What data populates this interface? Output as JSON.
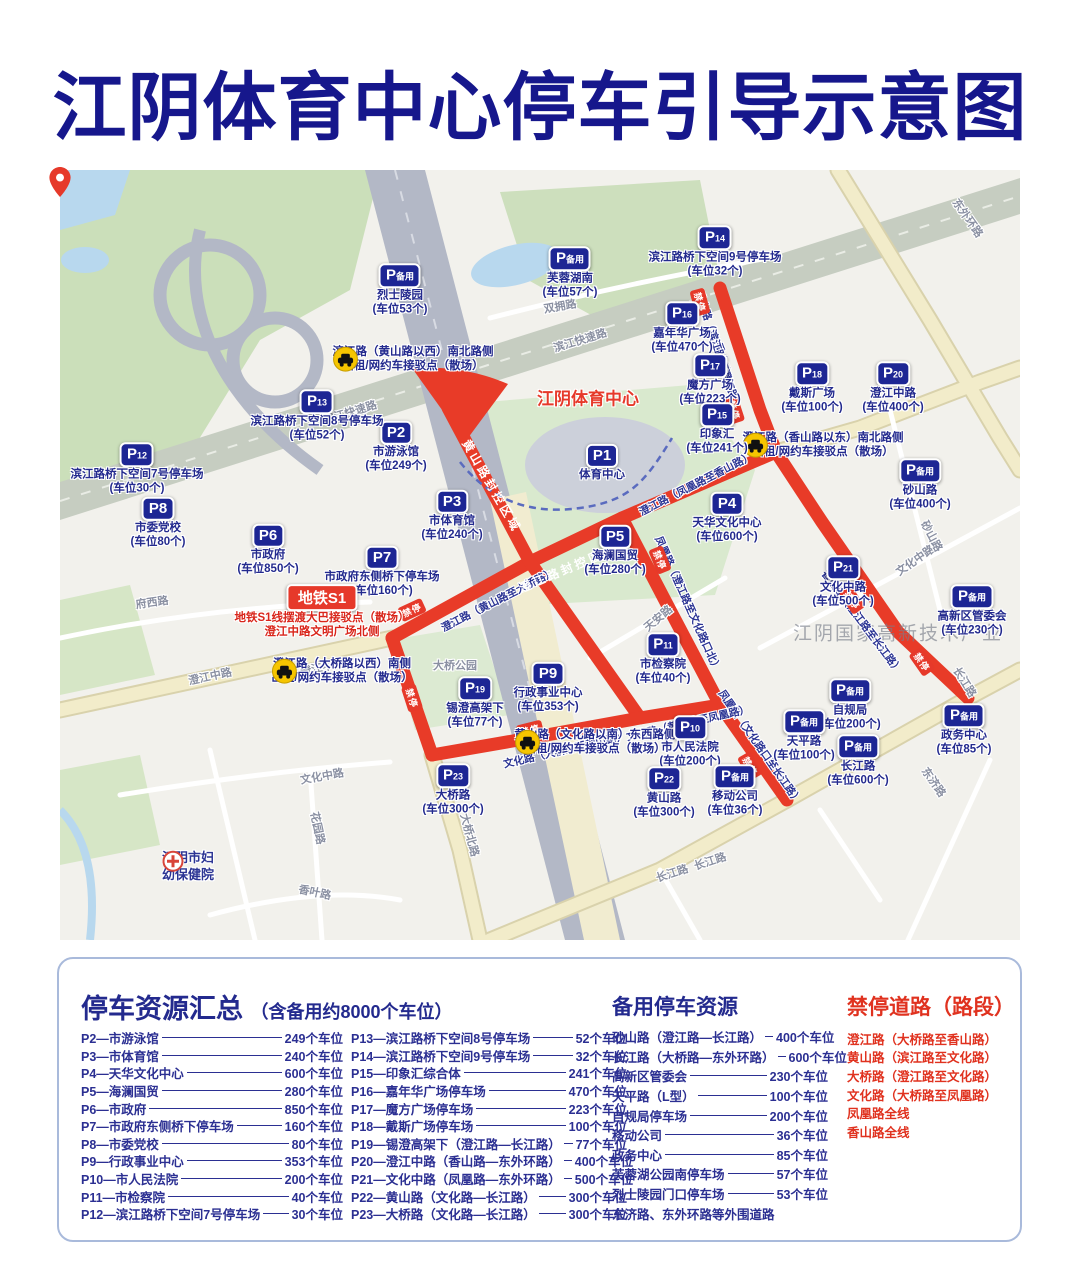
{
  "title": "江阴体育中心停车引导示意图",
  "map": {
    "stadium_label": "江阴体育中心",
    "watermark": "江阴国家高新技术产业",
    "no_stop_label": "禁停",
    "hospital": {
      "line1": "江阴市妇",
      "line2": "幼保健院"
    },
    "metro": {
      "badge": "地铁S1",
      "line1": "地铁S1线摆渡大巴接驳点（散场）",
      "line2": "澄江中路文明广场北侧"
    },
    "markers": [
      {
        "id": "P备用-烈士陵园",
        "badge": "P备用",
        "name": "烈士陵园",
        "cap": "(车位53个)",
        "x": 340,
        "y": 120
      },
      {
        "id": "P备用-芙蓉湖南",
        "badge": "P备用",
        "name": "芙蓉湖南",
        "cap": "(车位57个)",
        "x": 510,
        "y": 103
      },
      {
        "id": "P14",
        "badge": "P14",
        "name": "滨江路桥下空间9号停车场",
        "cap": "(车位32个)",
        "x": 655,
        "y": 82
      },
      {
        "id": "P16",
        "badge": "P16",
        "name": "嘉年华广场",
        "cap": "(车位470个)",
        "x": 622,
        "y": 158
      },
      {
        "id": "P17",
        "badge": "P17",
        "name": "魔方广场",
        "cap": "(车位223个)",
        "x": 650,
        "y": 210
      },
      {
        "id": "P18",
        "badge": "P18",
        "name": "戴斯广场",
        "cap": "(车位100个)",
        "x": 752,
        "y": 218
      },
      {
        "id": "P20",
        "badge": "P20",
        "name": "澄江中路",
        "cap": "(车位400个)",
        "x": 833,
        "y": 218
      },
      {
        "id": "P15",
        "badge": "P15",
        "name": "印象汇",
        "cap": "(车位241个)",
        "x": 657,
        "y": 259
      },
      {
        "id": "P1",
        "badge": "P1",
        "name": "体育中心",
        "cap": "",
        "x": 542,
        "y": 293
      },
      {
        "id": "P2",
        "badge": "P2",
        "name": "市游泳馆",
        "cap": "(车位249个)",
        "x": 336,
        "y": 277
      },
      {
        "id": "P3",
        "badge": "P3",
        "name": "市体育馆",
        "cap": "(车位240个)",
        "x": 392,
        "y": 346
      },
      {
        "id": "P13",
        "badge": "P13",
        "name": "滨江路桥下空间8号停车场",
        "cap": "(车位52个)",
        "x": 257,
        "y": 246
      },
      {
        "id": "P12",
        "badge": "P12",
        "name": "滨江路桥下空间7号停车场",
        "cap": "(车位30个)",
        "x": 77,
        "y": 299
      },
      {
        "id": "P8",
        "badge": "P8",
        "name": "市委党校",
        "cap": "(车位80个)",
        "x": 98,
        "y": 353
      },
      {
        "id": "P6",
        "badge": "P6",
        "name": "市政府",
        "cap": "(车位850个)",
        "x": 208,
        "y": 380
      },
      {
        "id": "P7",
        "badge": "P7",
        "name": "市政府东侧桥下停车场",
        "cap": "(车位160个)",
        "x": 322,
        "y": 402
      },
      {
        "id": "P5",
        "badge": "P5",
        "name": "海澜国贸",
        "cap": "(车位280个)",
        "x": 555,
        "y": 381
      },
      {
        "id": "P4",
        "badge": "P4",
        "name": "天华文化中心",
        "cap": "(车位600个)",
        "x": 667,
        "y": 348
      },
      {
        "id": "P21",
        "badge": "P21",
        "name": "文化中路",
        "cap": "(车位500个)",
        "x": 783,
        "y": 412
      },
      {
        "id": "P备用-砂山路",
        "badge": "P备用",
        "name": "砂山路",
        "cap": "(车位400个)",
        "x": 860,
        "y": 315
      },
      {
        "id": "P备用-高新区管委会",
        "badge": "P备用",
        "name": "高新区管委会",
        "cap": "(车位230个)",
        "x": 912,
        "y": 441
      },
      {
        "id": "P9",
        "badge": "P9",
        "name": "行政事业中心",
        "cap": "(车位353个)",
        "x": 488,
        "y": 518
      },
      {
        "id": "P11",
        "badge": "P11",
        "name": "市检察院",
        "cap": "(车位40个)",
        "x": 603,
        "y": 489
      },
      {
        "id": "P19",
        "badge": "P19",
        "name": "锡澄高架下",
        "cap": "(车位77个)",
        "x": 415,
        "y": 533
      },
      {
        "id": "P10",
        "badge": "P10",
        "name": "市人民法院",
        "cap": "(车位200个)",
        "x": 630,
        "y": 572
      },
      {
        "id": "P22",
        "badge": "P22",
        "name": "黄山路",
        "cap": "(车位300个)",
        "x": 604,
        "y": 623
      },
      {
        "id": "P23",
        "badge": "P23",
        "name": "大桥路",
        "cap": "(车位300个)",
        "x": 393,
        "y": 620
      },
      {
        "id": "P备用-移动公司",
        "badge": "P备用",
        "name": "移动公司",
        "cap": "(车位36个)",
        "x": 675,
        "y": 621
      },
      {
        "id": "P备用-自规局",
        "badge": "P备用",
        "name": "自规局",
        "cap": "(车位200个)",
        "x": 790,
        "y": 535
      },
      {
        "id": "P备用-天平路",
        "badge": "P备用",
        "name": "天平路",
        "cap": "(车位100个)",
        "x": 744,
        "y": 566
      },
      {
        "id": "P备用-长江路",
        "badge": "P备用",
        "name": "长江路",
        "cap": "(车位600个)",
        "x": 798,
        "y": 591
      },
      {
        "id": "P备用-政务中心",
        "badge": "P备用",
        "name": "政务中心",
        "cap": "(车位85个)",
        "x": 904,
        "y": 560
      }
    ],
    "taxi_points": [
      {
        "line1": "滨江路（黄山路以西）南北路侧",
        "line2": "出租/网约车接驳点（散场）",
        "x": 353,
        "y": 190
      },
      {
        "line1": "澄江路（香山路以东）南北路侧",
        "line2": "出租/网约车接驳点（散场）",
        "x": 763,
        "y": 276
      },
      {
        "line1": "澄江路（大桥路以西）南侧",
        "line2": "出租/网约车接驳点（散场）",
        "x": 282,
        "y": 502
      },
      {
        "line1": "黄山路（文化路以南）东西路侧",
        "line2": "出租/网约车接驳点（散场）",
        "x": 535,
        "y": 573
      }
    ],
    "road_labels": [
      {
        "t": "双拥路",
        "x": 500,
        "y": 136,
        "r": -10,
        "k": "gray"
      },
      {
        "t": "东外环路",
        "x": 908,
        "y": 48,
        "r": 55,
        "k": "gray"
      },
      {
        "t": "滨江快速路",
        "x": 290,
        "y": 242,
        "r": -17,
        "k": "gray"
      },
      {
        "t": "滨江快速路",
        "x": 520,
        "y": 170,
        "r": -17,
        "k": "gray"
      },
      {
        "t": "澄江中路",
        "x": 150,
        "y": 506,
        "r": -12,
        "k": "gray"
      },
      {
        "t": "澄江中路",
        "x": 262,
        "y": 497,
        "r": -12,
        "k": "gray"
      },
      {
        "t": "府西路",
        "x": 92,
        "y": 432,
        "r": -8,
        "k": "gray"
      },
      {
        "t": "大桥公园",
        "x": 395,
        "y": 495,
        "r": 0,
        "k": "gray"
      },
      {
        "t": "天安路",
        "x": 598,
        "y": 448,
        "r": -40,
        "k": "gray"
      },
      {
        "t": "文化中路",
        "x": 855,
        "y": 390,
        "r": -35,
        "k": "gray"
      },
      {
        "t": "文化中路",
        "x": 262,
        "y": 606,
        "r": -10,
        "k": "gray"
      },
      {
        "t": "砂山路",
        "x": 872,
        "y": 366,
        "r": 62,
        "k": "gray"
      },
      {
        "t": "长江路",
        "x": 612,
        "y": 703,
        "r": -18,
        "k": "gray"
      },
      {
        "t": "长江路",
        "x": 650,
        "y": 691,
        "r": -18,
        "k": "gray"
      },
      {
        "t": "长江路",
        "x": 905,
        "y": 512,
        "r": 58,
        "k": "gray"
      },
      {
        "t": "东济路",
        "x": 874,
        "y": 612,
        "r": 55,
        "k": "gray"
      },
      {
        "t": "大桥北路",
        "x": 410,
        "y": 665,
        "r": 75,
        "k": "gray"
      },
      {
        "t": "花园路",
        "x": 258,
        "y": 658,
        "r": 78,
        "k": "gray"
      },
      {
        "t": "香叶路",
        "x": 255,
        "y": 722,
        "r": 12,
        "k": "gray"
      },
      {
        "t": "香山路",
        "x": 662,
        "y": 188,
        "r": 75,
        "k": "navy"
      },
      {
        "t": "香山路（滨江路至澄江路）",
        "x": 658,
        "y": 180,
        "r": 72,
        "k": "navy"
      },
      {
        "t": "澄江路（黄山路至大桥路）",
        "x": 438,
        "y": 430,
        "r": -27,
        "k": "navy"
      },
      {
        "t": "澄江路（凤凰路至香山路）",
        "x": 636,
        "y": 314,
        "r": -27,
        "k": "navy"
      },
      {
        "t": "凤凰路（澄江路至文化路口北）",
        "x": 628,
        "y": 434,
        "r": 66,
        "k": "navy"
      },
      {
        "t": "凤凰路（文化路口至长江路）",
        "x": 700,
        "y": 577,
        "r": 55,
        "k": "navy"
      },
      {
        "t": "文化路（大桥路至黄山路）",
        "x": 505,
        "y": 580,
        "r": -13,
        "k": "navy"
      },
      {
        "t": "文化路（黄山路至凤凰路）",
        "x": 628,
        "y": 553,
        "r": -13,
        "k": "navy"
      },
      {
        "t": "香山路（澄江路至长江路）",
        "x": 802,
        "y": 452,
        "r": 53,
        "k": "navy"
      },
      {
        "t": "黄山路封控区域",
        "x": 432,
        "y": 316,
        "r": 60,
        "k": "white"
      },
      {
        "t": "澄江路封控区域",
        "x": 508,
        "y": 398,
        "r": -23,
        "k": "white"
      }
    ],
    "no_stop_chips": [
      {
        "x": 640,
        "y": 132,
        "r": 75
      },
      {
        "x": 674,
        "y": 240,
        "r": 72
      },
      {
        "x": 352,
        "y": 440,
        "r": -25
      },
      {
        "x": 352,
        "y": 528,
        "r": 72
      },
      {
        "x": 600,
        "y": 390,
        "r": 68
      },
      {
        "x": 792,
        "y": 430,
        "r": 55
      },
      {
        "x": 862,
        "y": 492,
        "r": 55
      },
      {
        "x": 690,
        "y": 596,
        "r": 60
      },
      {
        "x": 470,
        "y": 560,
        "r": -14
      }
    ]
  },
  "legend": {
    "main_title": "停车资源汇总",
    "main_subtitle": "（含备用约8000个车位）",
    "backup_title": "备用停车资源",
    "no_parking_title": "禁停道路（路段）",
    "list_left": [
      {
        "label": "P2—市游泳馆",
        "value": "249个车位"
      },
      {
        "label": "P3—市体育馆",
        "value": "240个车位"
      },
      {
        "label": "P4—天华文化中心",
        "value": "600个车位"
      },
      {
        "label": "P5—海澜国贸",
        "value": "280个车位"
      },
      {
        "label": "P6—市政府",
        "value": "850个车位"
      },
      {
        "label": "P7—市政府东侧桥下停车场",
        "value": "160个车位"
      },
      {
        "label": "P8—市委党校",
        "value": "80个车位"
      },
      {
        "label": "P9—行政事业中心",
        "value": "353个车位"
      },
      {
        "label": "P10—市人民法院",
        "value": "200个车位"
      },
      {
        "label": "P11—市检察院",
        "value": "40个车位"
      },
      {
        "label": "P12—滨江路桥下空间7号停车场",
        "value": "30个车位"
      }
    ],
    "list_right": [
      {
        "label": "P13—滨江路桥下空间8号停车场",
        "value": "52个车位"
      },
      {
        "label": "P14—滨江路桥下空间9号停车场",
        "value": "32个车位"
      },
      {
        "label": "P15—印象汇综合体",
        "value": "241个车位"
      },
      {
        "label": "P16—嘉年华广场停车场",
        "value": "470个车位"
      },
      {
        "label": "P17—魔方广场停车场",
        "value": "223个车位"
      },
      {
        "label": "P18—戴斯广场停车场",
        "value": "100个车位"
      },
      {
        "label": "P19—锡澄高架下（澄江路—长江路）",
        "value": "77个车位"
      },
      {
        "label": "P20—澄江中路（香山路—东外环路）",
        "value": "400个车位"
      },
      {
        "label": "P21—文化中路（凤凰路—东外环路）",
        "value": "500个车位"
      },
      {
        "label": "P22—黄山路（文化路—长江路）",
        "value": "300个车位"
      },
      {
        "label": "P23—大桥路（文化路—长江路）",
        "value": "300个车位"
      }
    ],
    "backup_list": [
      {
        "label": "砂山路（澄江路—长江路）",
        "value": "400个车位"
      },
      {
        "label": "长江路（大桥路—东外环路）",
        "value": "600个车位"
      },
      {
        "label": "高新区管委会",
        "value": "230个车位"
      },
      {
        "label": "天平路（L型）",
        "value": "100个车位"
      },
      {
        "label": "自规局停车场",
        "value": "200个车位"
      },
      {
        "label": "移动公司",
        "value": "36个车位"
      },
      {
        "label": "政务中心",
        "value": "85个车位"
      },
      {
        "label": "芙蓉湖公园南停车场",
        "value": "57个车位"
      },
      {
        "label": "烈士陵园门口停车场",
        "value": "53个车位"
      },
      {
        "label": "东济路、东外环路等外围道路",
        "value": ""
      }
    ],
    "no_parking_list": [
      "澄江路（大桥路至香山路）",
      "黄山路（滨江路至文化路）",
      "大桥路（澄江路至文化路）",
      "文化路（大桥路至凤凰路）",
      "凤凰路全线",
      "香山路全线"
    ]
  }
}
